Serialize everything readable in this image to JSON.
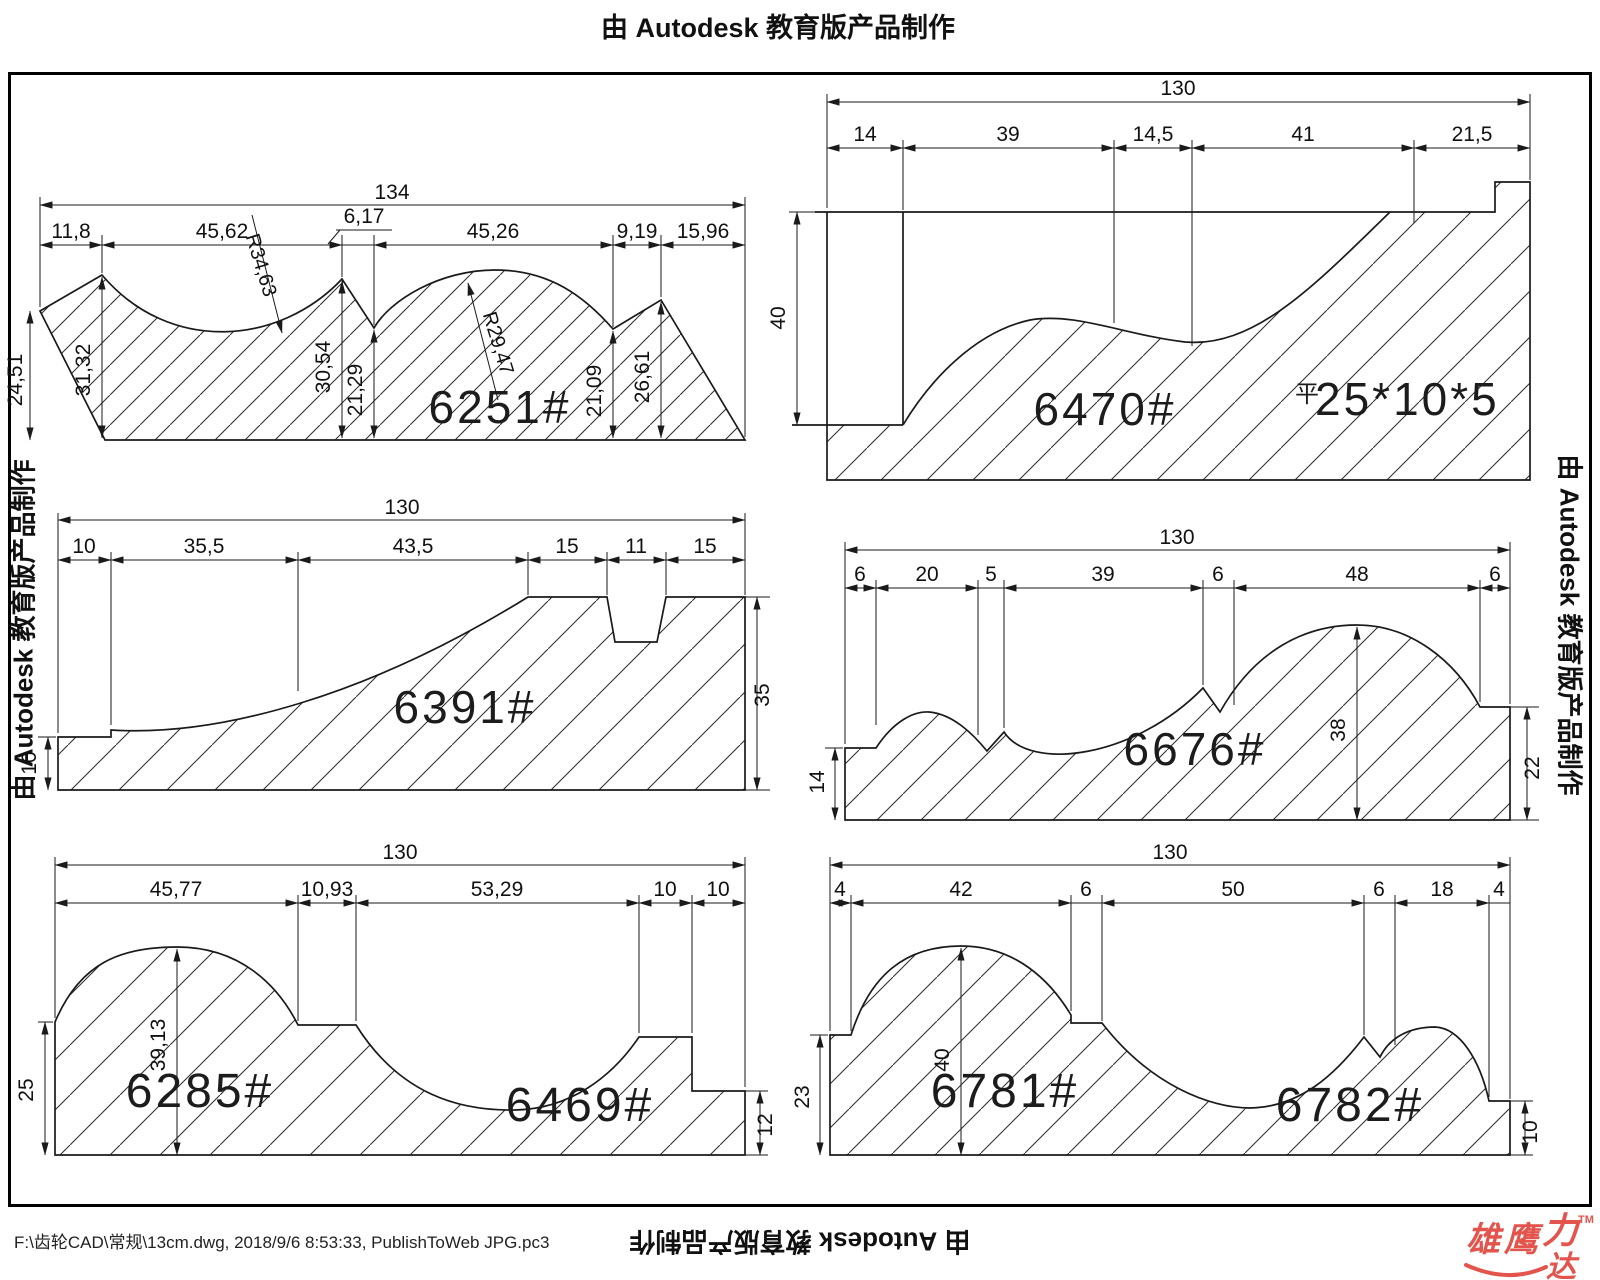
{
  "sheet": {
    "title_top": "由 Autodesk 教育版产品制作",
    "side_left": "由 Autodesk 教育版产品制作",
    "side_right": "由 Autodesk 教育版产品制作",
    "bottom_center": "由 Autodesk 教育版产品制作",
    "footer": "F:\\齿轮CAD\\常规\\13cm.dwg, 2018/9/6 8:53:33, PublishToWeb JPG.pc3",
    "logo": {
      "main": "雄鹰",
      "li": "力",
      "da": "达",
      "tm": "TM"
    },
    "colors": {
      "line": "#1a1a1a",
      "logo_red": "#e2544c",
      "background": "#ffffff"
    }
  },
  "drawings": [
    {
      "label": "6251#",
      "overall": "134",
      "dims": [
        "11,8",
        "45,62",
        "6,17",
        "45,26",
        "9,19",
        "15,96"
      ],
      "heights": [
        "24,51",
        "31,32",
        "30,54",
        "21,29",
        "21,09",
        "26,61"
      ],
      "radii": [
        "R34,63",
        "R29,47"
      ]
    },
    {
      "label": "6470#",
      "overall": "130",
      "dims": [
        "14",
        "39",
        "14,5",
        "41",
        "21,5"
      ],
      "heights": [
        "40"
      ],
      "flat_prefix": "平",
      "flat_label": "25*10*5"
    },
    {
      "label": "6391#",
      "overall": "130",
      "dims": [
        "10",
        "35,5",
        "43,5",
        "15",
        "11",
        "15"
      ],
      "heights": [
        "35",
        "10"
      ]
    },
    {
      "label": "6676#",
      "overall": "130",
      "dims": [
        "6",
        "20",
        "5",
        "39",
        "6",
        "48",
        "6"
      ],
      "heights": [
        "38",
        "14",
        "22"
      ]
    },
    {
      "label": "6285#",
      "label2": "6469#",
      "overall": "130",
      "dims": [
        "45,77",
        "10,93",
        "53,29",
        "10",
        "10"
      ],
      "heights": [
        "39,13",
        "25",
        "12"
      ]
    },
    {
      "label": "6781#",
      "label2": "6782#",
      "overall": "130",
      "dims": [
        "4",
        "42",
        "6",
        "50",
        "6",
        "18",
        "4"
      ],
      "heights": [
        "40",
        "23",
        "10"
      ]
    }
  ]
}
